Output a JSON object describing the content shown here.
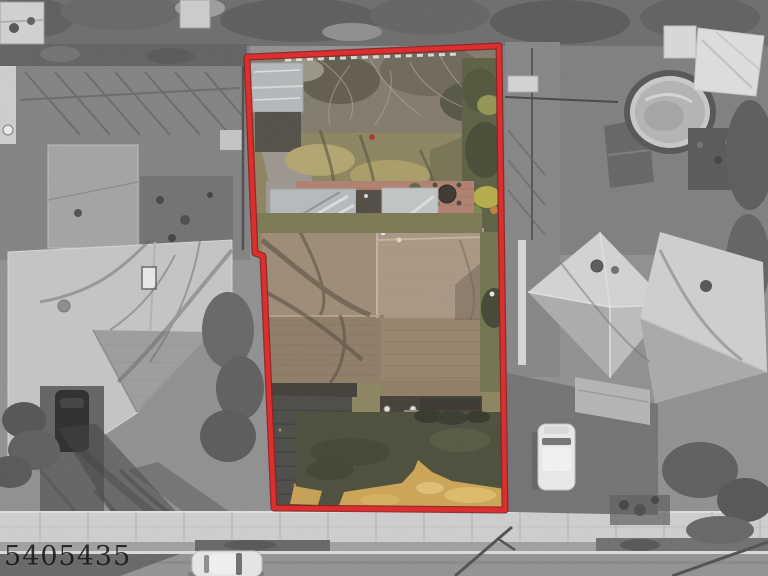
{
  "image": {
    "kind": "real-estate aerial photograph",
    "description": "Overhead drone photo of a residential lot; subject parcel shown in color and outlined in red, surrounding properties desaturated to grayscale",
    "watermark": "5405435"
  },
  "boundary": {
    "points": "247,57 499,46 505,510 274,508 263,256 255,253",
    "stroke": "#e02020",
    "stroke_dark": "#8a1111"
  },
  "palette": {
    "grayscale_base": "#8d8d8d",
    "sidewalk": "#cfcfcf",
    "street": "#909090",
    "backyard_lawn": "#8a8159",
    "front_lawn": "#454733",
    "dry_grass_gold": "#cda44f",
    "house_roof_tan": "#a79480",
    "brick_patio": "#b07c6a",
    "canopy_gray": "#b6babc"
  }
}
